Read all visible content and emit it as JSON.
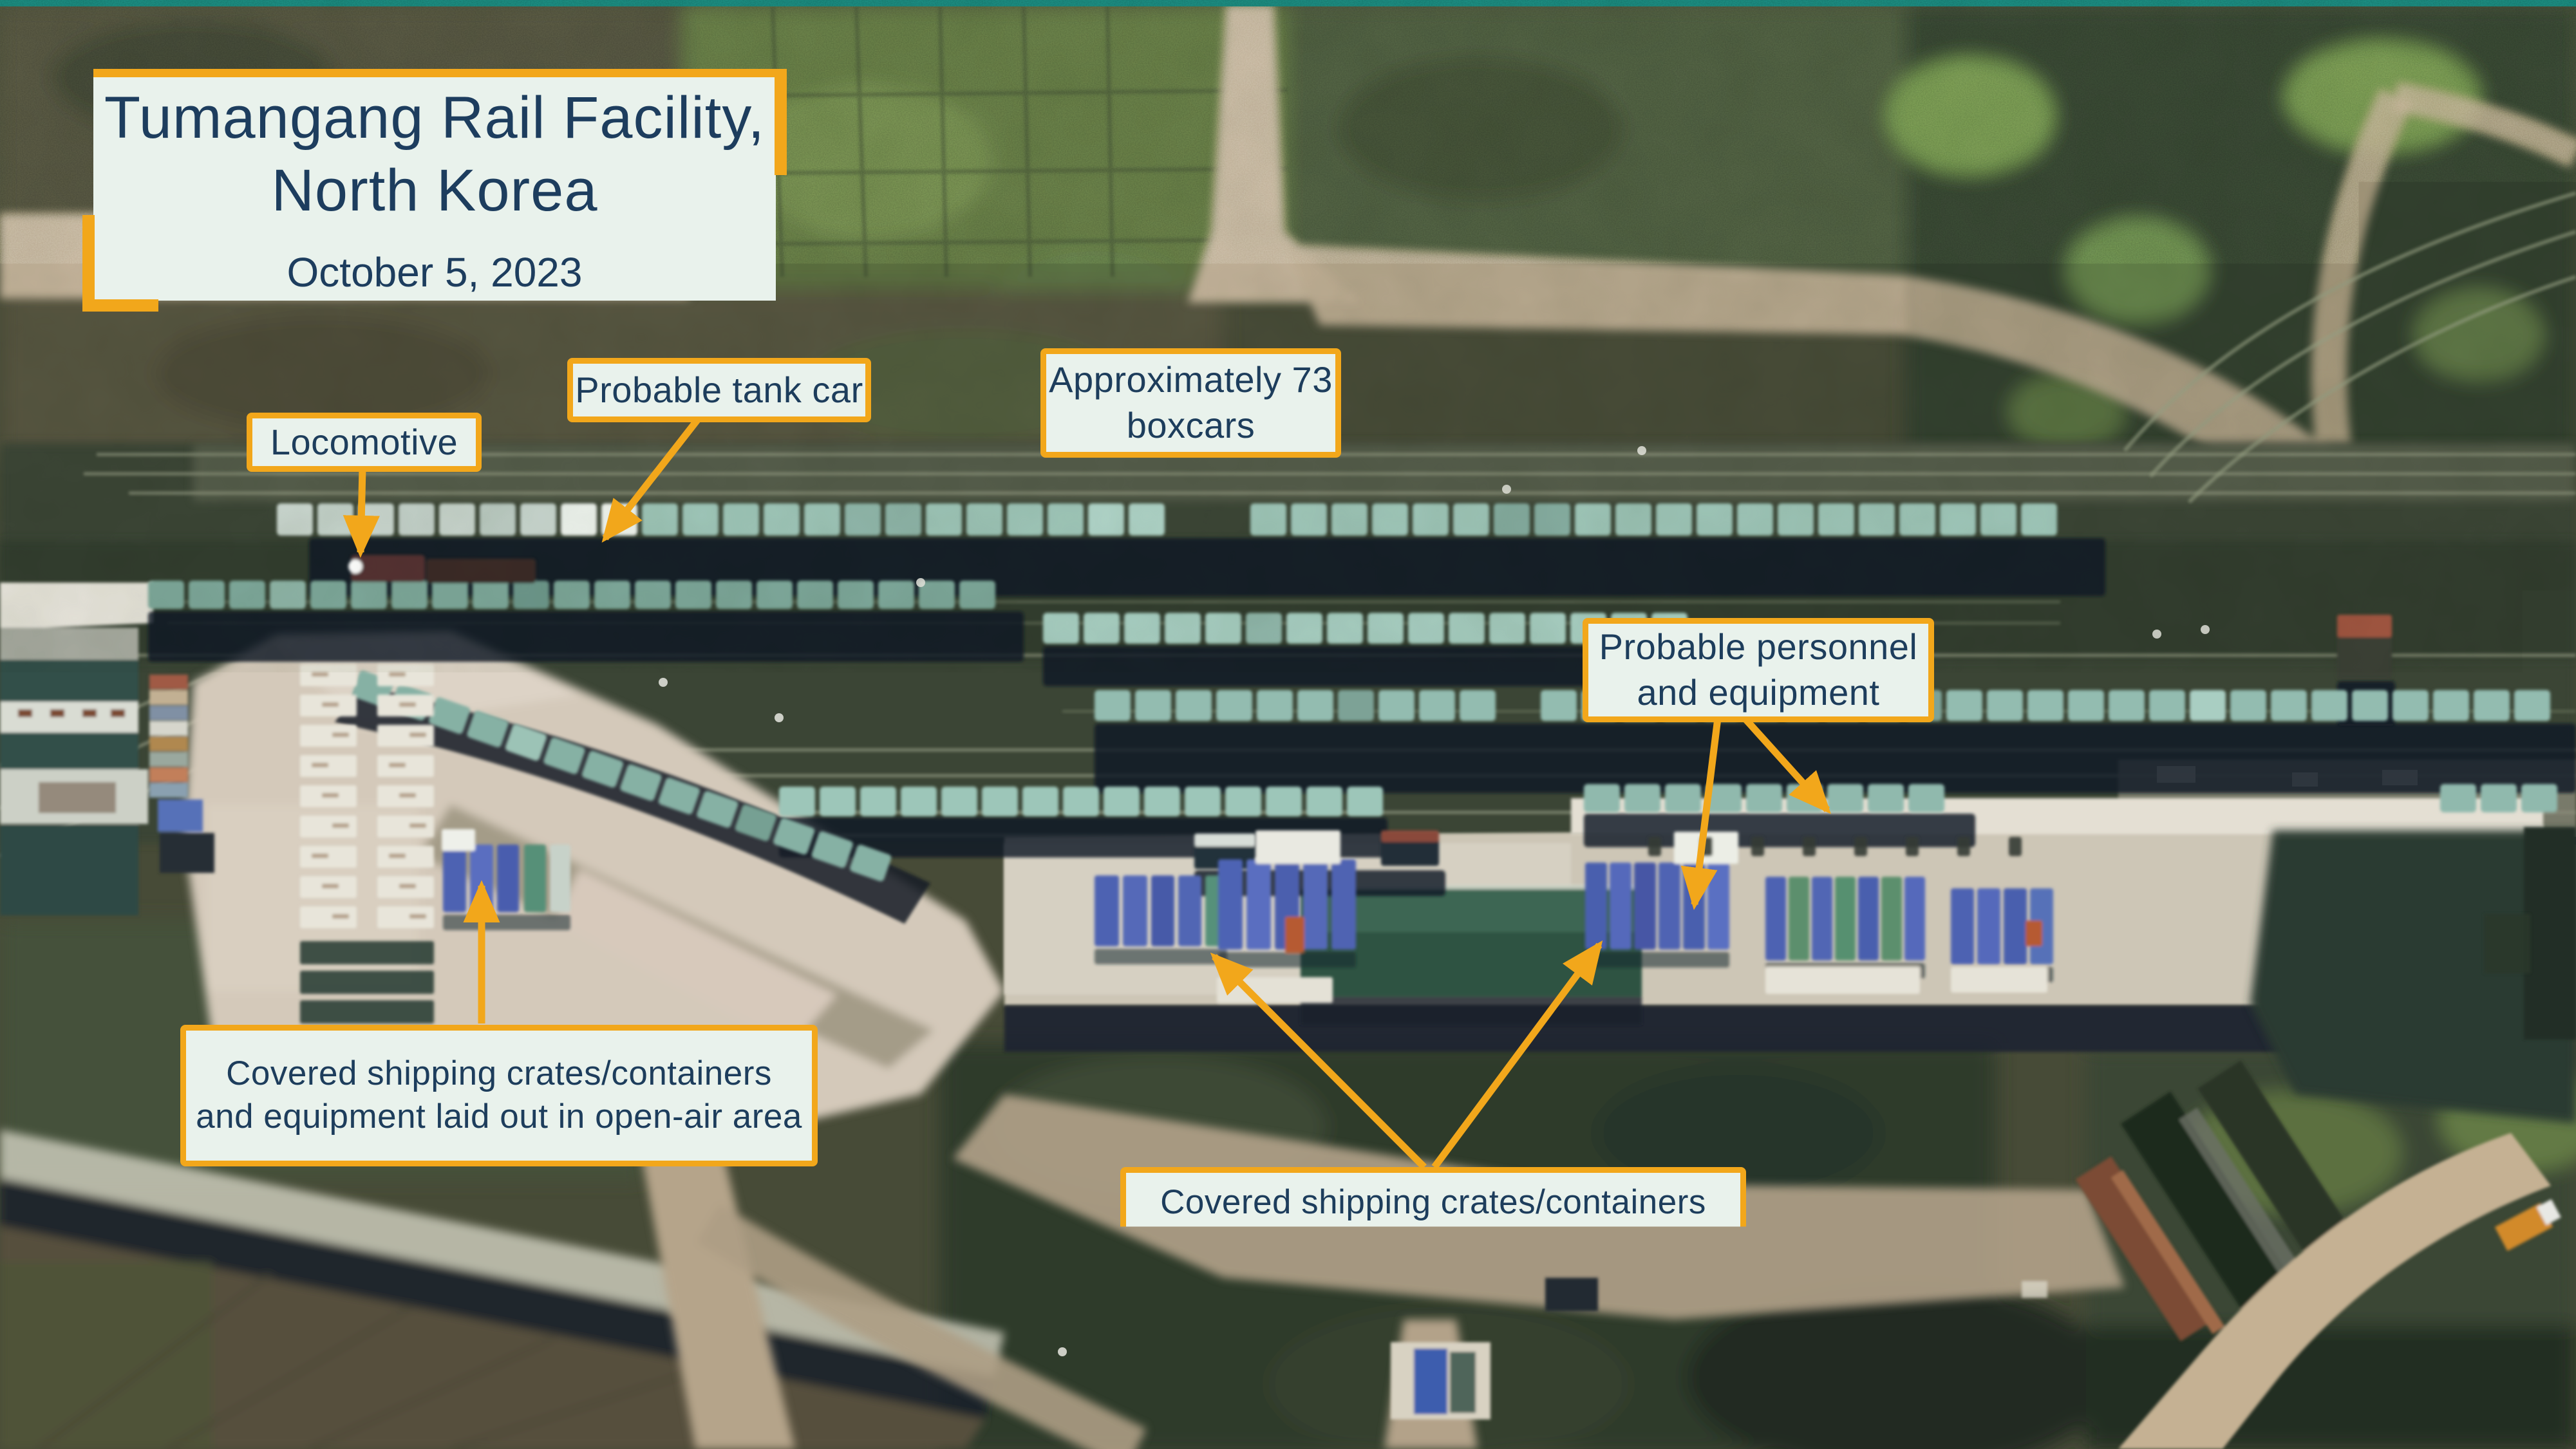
{
  "title_card": {
    "title_line1": "Tumangang Rail Facility,",
    "title_line2": "North Korea",
    "date": "October 5, 2023"
  },
  "labels": {
    "tank_car": {
      "text": "Probable tank car"
    },
    "locomotive": {
      "text": "Locomotive"
    },
    "boxcars": {
      "line1": "Approximately 73",
      "line2": "boxcars"
    },
    "personnel": {
      "line1": "Probable personnel",
      "line2": "and equipment"
    },
    "covered_left": {
      "line1": "Covered shipping crates/containers",
      "line2": "and equipment laid out in open-air area"
    },
    "covered_bottom": {
      "line1": "Covered shipping crates/containers",
      "line2": "and equipment laid out in open-air area"
    }
  },
  "footer": {
    "copyright": "Copyright © 2023 by Planet"
  },
  "logo": {
    "org": "CSIS",
    "beyond": "BEYOND",
    "para": "PARA",
    "el": "EL"
  },
  "compass": {
    "north": "N",
    "south": "S",
    "east": "E",
    "west": "W"
  },
  "colors": {
    "accent_yellow": "#F2A71B",
    "box_background": "#E9F2EC",
    "label_text": "#1D3D5C",
    "credit_text": "#FFFFFF",
    "top_edge_teal": "#177A72"
  }
}
